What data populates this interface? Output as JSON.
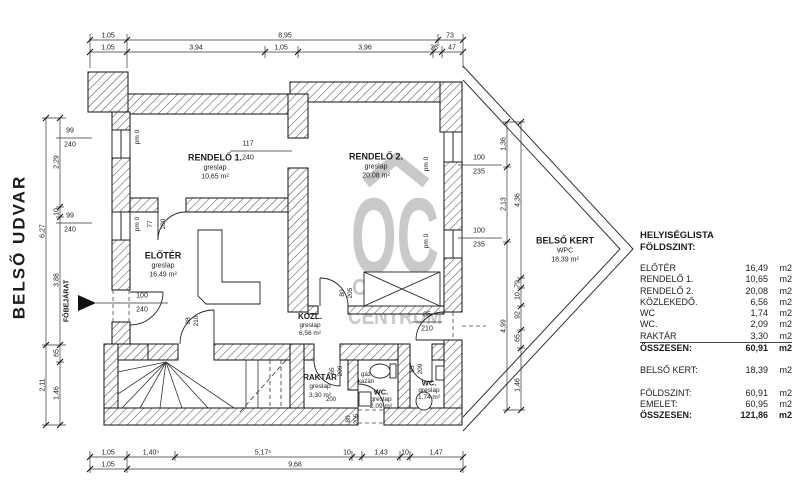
{
  "page": {
    "background": "#ffffff",
    "ink": "#1c1c1c",
    "watermark_color": "#c9c9c9"
  },
  "watermark": {
    "letters": "OC",
    "line1": "OTTHON",
    "line2": "CENTRUM"
  },
  "room_list": {
    "title_lines": [
      "HELYISÉGLISTA",
      "FÖLDSZINT:"
    ],
    "rows": [
      {
        "name": "ELŐTÉR",
        "value": "16,49",
        "unit": "m2"
      },
      {
        "name": "RENDELŐ 1.",
        "value": "10,65",
        "unit": "m2"
      },
      {
        "name": "RENDELŐ 2.",
        "value": "20,08",
        "unit": "m2"
      },
      {
        "name": "KÖZLEKEDŐ.",
        "value": "6,56",
        "unit": "m2"
      },
      {
        "name": "WC",
        "value": "1,74",
        "unit": "m2"
      },
      {
        "name": "WC.",
        "value": "2,09",
        "unit": "m2"
      },
      {
        "name": "RAKTÁR",
        "value": "3,30",
        "unit": "m2",
        "rule": true
      },
      {
        "name": "ÖSSZESEN:",
        "value": "60,91",
        "unit": "m2",
        "bold": true
      },
      {
        "gap": true
      },
      {
        "name": "BELSŐ KERT:",
        "value": "18,39",
        "unit": "m2"
      },
      {
        "gap": true
      },
      {
        "name": "FÖLDSZINT:",
        "value": "60,91",
        "unit": "m2"
      },
      {
        "name": "EMELET:",
        "value": "60,95",
        "unit": "m2"
      },
      {
        "name": "ÖSSZESEN:",
        "value": "121,86",
        "unit": "m2",
        "bold": true
      }
    ]
  },
  "plan_labels": [
    {
      "t": "BELSŐ UDVAR",
      "x": 19,
      "y": 247,
      "s": 17,
      "b": true,
      "r": true,
      "ls": 2
    },
    {
      "t": "FŐBEJÁRAT",
      "x": 67,
      "y": 301,
      "s": 7,
      "b": true,
      "r": true
    },
    {
      "t": "1,05",
      "x": 108,
      "y": 36
    },
    {
      "t": "8,95",
      "x": 285,
      "y": 36
    },
    {
      "t": "73",
      "x": 450,
      "y": 36
    },
    {
      "t": "1,05",
      "x": 108,
      "y": 48
    },
    {
      "t": "3,94",
      "x": 196,
      "y": 48
    },
    {
      "t": "1,05",
      "x": 281,
      "y": 48
    },
    {
      "t": "3,96",
      "x": 365,
      "y": 48
    },
    {
      "t": "26",
      "x": 434,
      "y": 48
    },
    {
      "t": "47",
      "x": 452,
      "y": 48
    },
    {
      "t": "1,05",
      "x": 108,
      "y": 453
    },
    {
      "t": "1,40⁵",
      "x": 151,
      "y": 453
    },
    {
      "t": "5,17⁵",
      "x": 263,
      "y": 453
    },
    {
      "t": "10",
      "x": 347,
      "y": 453
    },
    {
      "t": "1,43",
      "x": 381,
      "y": 453
    },
    {
      "t": "10",
      "x": 405,
      "y": 453
    },
    {
      "t": "1,47",
      "x": 436,
      "y": 453
    },
    {
      "t": "1,05",
      "x": 108,
      "y": 465
    },
    {
      "t": "9,68",
      "x": 295,
      "y": 465
    },
    {
      "t": "2,29",
      "x": 57,
      "y": 162,
      "r": true
    },
    {
      "t": "10",
      "x": 57,
      "y": 212,
      "r": true
    },
    {
      "t": "3,88",
      "x": 57,
      "y": 280,
      "r": true
    },
    {
      "t": "6,27",
      "x": 43,
      "y": 231,
      "r": true
    },
    {
      "t": "65",
      "x": 57,
      "y": 353,
      "r": true
    },
    {
      "t": "1,46",
      "x": 57,
      "y": 393,
      "r": true
    },
    {
      "t": "2,11",
      "x": 43,
      "y": 385,
      "r": true
    },
    {
      "t": "1,36",
      "x": 504,
      "y": 144,
      "r": true
    },
    {
      "t": "2,13",
      "x": 504,
      "y": 204,
      "r": true
    },
    {
      "t": "4,99",
      "x": 504,
      "y": 326,
      "r": true
    },
    {
      "t": "4,36",
      "x": 518,
      "y": 200,
      "r": true
    },
    {
      "t": "79",
      "x": 518,
      "y": 284,
      "r": true
    },
    {
      "t": "10",
      "x": 518,
      "y": 296,
      "r": true
    },
    {
      "t": "92",
      "x": 518,
      "y": 315,
      "r": true
    },
    {
      "t": "65",
      "x": 518,
      "y": 338,
      "r": true
    },
    {
      "t": "1,46",
      "x": 518,
      "y": 385,
      "r": true
    },
    {
      "t": "99",
      "x": 70,
      "y": 131
    },
    {
      "t": "240",
      "x": 70,
      "y": 145
    },
    {
      "t": "99",
      "x": 70,
      "y": 216
    },
    {
      "t": "240",
      "x": 70,
      "y": 230
    },
    {
      "t": "100",
      "x": 142,
      "y": 296
    },
    {
      "t": "240",
      "x": 142,
      "y": 310
    },
    {
      "t": "117",
      "x": 248,
      "y": 144
    },
    {
      "t": "240",
      "x": 248,
      "y": 158
    },
    {
      "t": "100",
      "x": 479,
      "y": 158
    },
    {
      "t": "235",
      "x": 479,
      "y": 172
    },
    {
      "t": "100",
      "x": 479,
      "y": 231
    },
    {
      "t": "235",
      "x": 479,
      "y": 245
    },
    {
      "t": "85",
      "x": 427,
      "y": 315
    },
    {
      "t": "210",
      "x": 427,
      "y": 329
    },
    {
      "t": "77",
      "x": 151,
      "y": 224,
      "s": 6.5,
      "r": true
    },
    {
      "t": "200",
      "x": 164,
      "y": 224,
      "s": 6.5,
      "r": true
    },
    {
      "t": "98",
      "x": 189,
      "y": 321,
      "s": 6.5,
      "r": true
    },
    {
      "t": "210",
      "x": 197,
      "y": 321,
      "s": 6.5,
      "r": true
    },
    {
      "t": "80",
      "x": 343,
      "y": 293,
      "s": 6.5,
      "r": true
    },
    {
      "t": "205",
      "x": 351,
      "y": 293,
      "s": 6.5,
      "r": true
    },
    {
      "t": "65",
      "x": 333,
      "y": 371,
      "s": 6.5,
      "r": true
    },
    {
      "t": "209",
      "x": 341,
      "y": 371,
      "s": 6.5,
      "r": true
    },
    {
      "t": "200",
      "x": 331,
      "y": 400,
      "s": 6
    },
    {
      "t": "65",
      "x": 413,
      "y": 369,
      "s": 6.5,
      "r": true
    },
    {
      "t": "209",
      "x": 421,
      "y": 369,
      "s": 6.5,
      "r": true
    },
    {
      "t": "80",
      "x": 349,
      "y": 419,
      "s": 6.5,
      "r": true
    },
    {
      "t": "205",
      "x": 357,
      "y": 419,
      "s": 6.5,
      "r": true
    },
    {
      "t": "pm 0",
      "x": 138,
      "y": 137,
      "s": 6.5,
      "r": true
    },
    {
      "t": "pm 0",
      "x": 138,
      "y": 224,
      "s": 6.5,
      "r": true
    },
    {
      "t": "pm 0",
      "x": 427,
      "y": 164,
      "s": 6.5,
      "r": true
    },
    {
      "t": "pm 0",
      "x": 427,
      "y": 241,
      "s": 6.5,
      "r": true
    },
    {
      "t": "RENDELŐ 1.",
      "x": 215,
      "y": 158,
      "s": 9,
      "b": true
    },
    {
      "t": "greslap",
      "x": 215,
      "y": 168
    },
    {
      "t": "10,65 m²",
      "x": 215,
      "y": 177
    },
    {
      "t": "RENDELŐ 2.",
      "x": 376,
      "y": 157,
      "s": 9,
      "b": true
    },
    {
      "t": "greslap",
      "x": 376,
      "y": 167
    },
    {
      "t": "20,08 m²",
      "x": 376,
      "y": 176
    },
    {
      "t": "ELŐTÉR",
      "x": 163,
      "y": 256,
      "s": 9,
      "b": true
    },
    {
      "t": "greslap",
      "x": 163,
      "y": 266
    },
    {
      "t": "16,49 m²",
      "x": 163,
      "y": 275
    },
    {
      "t": "KÖZL.",
      "x": 310,
      "y": 317,
      "s": 8,
      "b": true
    },
    {
      "t": "greslap",
      "x": 310,
      "y": 326,
      "s": 6.5
    },
    {
      "t": "6,56 m²",
      "x": 310,
      "y": 334,
      "s": 6.5
    },
    {
      "t": "RAKTÁR",
      "x": 320,
      "y": 378,
      "s": 8,
      "b": true
    },
    {
      "t": "greslap",
      "x": 320,
      "y": 387,
      "s": 6.5
    },
    {
      "t": "3,30 m²",
      "x": 320,
      "y": 396,
      "s": 6.5
    },
    {
      "t": "gáz",
      "x": 366,
      "y": 375,
      "s": 6
    },
    {
      "t": "kazán",
      "x": 366,
      "y": 382,
      "s": 6
    },
    {
      "t": "WC.",
      "x": 381,
      "y": 392,
      "s": 7.5,
      "b": true
    },
    {
      "t": "greslap",
      "x": 381,
      "y": 400,
      "s": 6.5
    },
    {
      "t": "2,09 m²",
      "x": 381,
      "y": 407,
      "s": 6.5
    },
    {
      "t": "WC.",
      "x": 429,
      "y": 383,
      "s": 7.5,
      "b": true
    },
    {
      "t": "greslap",
      "x": 429,
      "y": 391,
      "s": 6.5
    },
    {
      "t": "1,74 m²",
      "x": 429,
      "y": 398,
      "s": 6.5
    },
    {
      "t": "BELSŐ KERT",
      "x": 565,
      "y": 241,
      "s": 9,
      "b": true
    },
    {
      "t": "WPC",
      "x": 565,
      "y": 251
    },
    {
      "t": "18,39 m²",
      "x": 565,
      "y": 260
    }
  ]
}
